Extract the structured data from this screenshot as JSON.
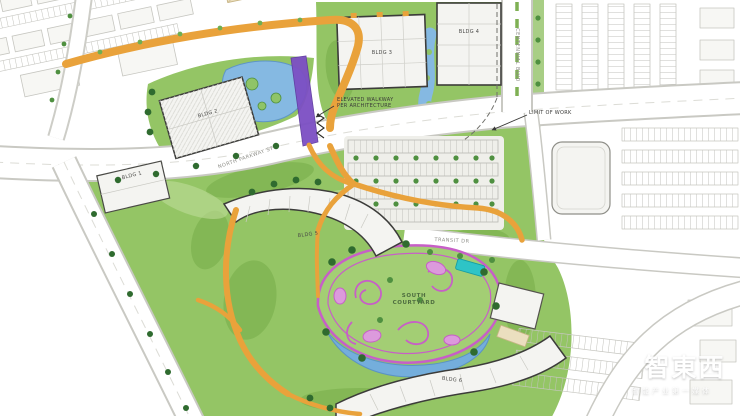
{
  "map": {
    "buildings": [
      {
        "id": "bldg-1",
        "label": "BLDG 1"
      },
      {
        "id": "bldg-2",
        "label": "BLDG 2"
      },
      {
        "id": "bldg-3",
        "label": "BLDG 3"
      },
      {
        "id": "bldg-4",
        "label": "BLDG 4"
      },
      {
        "id": "bldg-5",
        "label": "BLDG 5"
      },
      {
        "id": "bldg-6",
        "label": "BLDG 6"
      }
    ],
    "places": {
      "south_courtyard": "SOUTH\nCOURTYARD"
    },
    "streets": {
      "north_parkway": "NORTH PARKWAY ST",
      "east_blvd": "CENTENNIAL BLVD",
      "transit_dr": "TRANSIT DR"
    },
    "annotations": {
      "elevated_walkway": "ELEVATED WALKWAY\nPER ARCHITECTURE",
      "limit_of_work": "LIMIT OF WORK"
    },
    "colors": {
      "lawn": "#94C565",
      "lawn_dark": "#76AC49",
      "water": "#85B9E2",
      "path_orange": "#E9A23B",
      "elevated_walkway_purple": "#7C4FC4",
      "courtyard_pink": "#C75FC7",
      "plaza_teal": "#2EC4C6",
      "building_fill": "#F4F4F1",
      "building_outline": "#3C3C3A"
    }
  },
  "watermark": {
    "brand": "智東西",
    "tagline": "智能产业第一媒体"
  }
}
